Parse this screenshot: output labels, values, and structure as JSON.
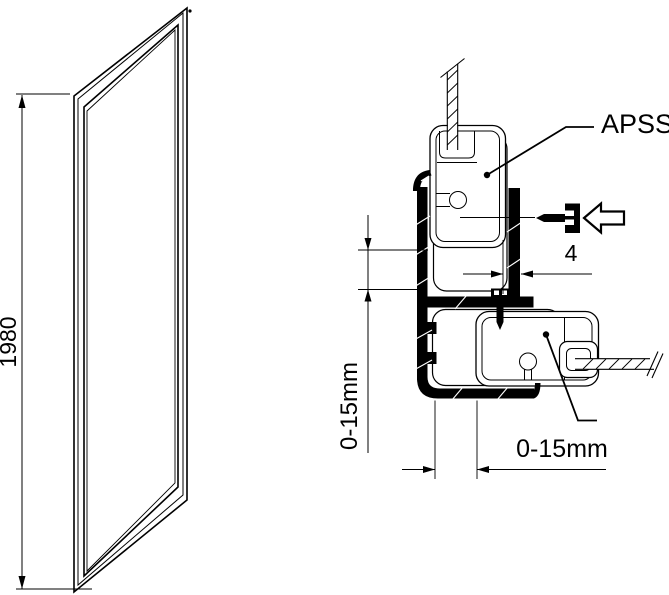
{
  "labels": {
    "panel_height": "1980",
    "profile_name": "APSS",
    "gap": "4",
    "vertical_adjustment": "0-15mm",
    "horizontal_adjustment": "0-15mm"
  }
}
